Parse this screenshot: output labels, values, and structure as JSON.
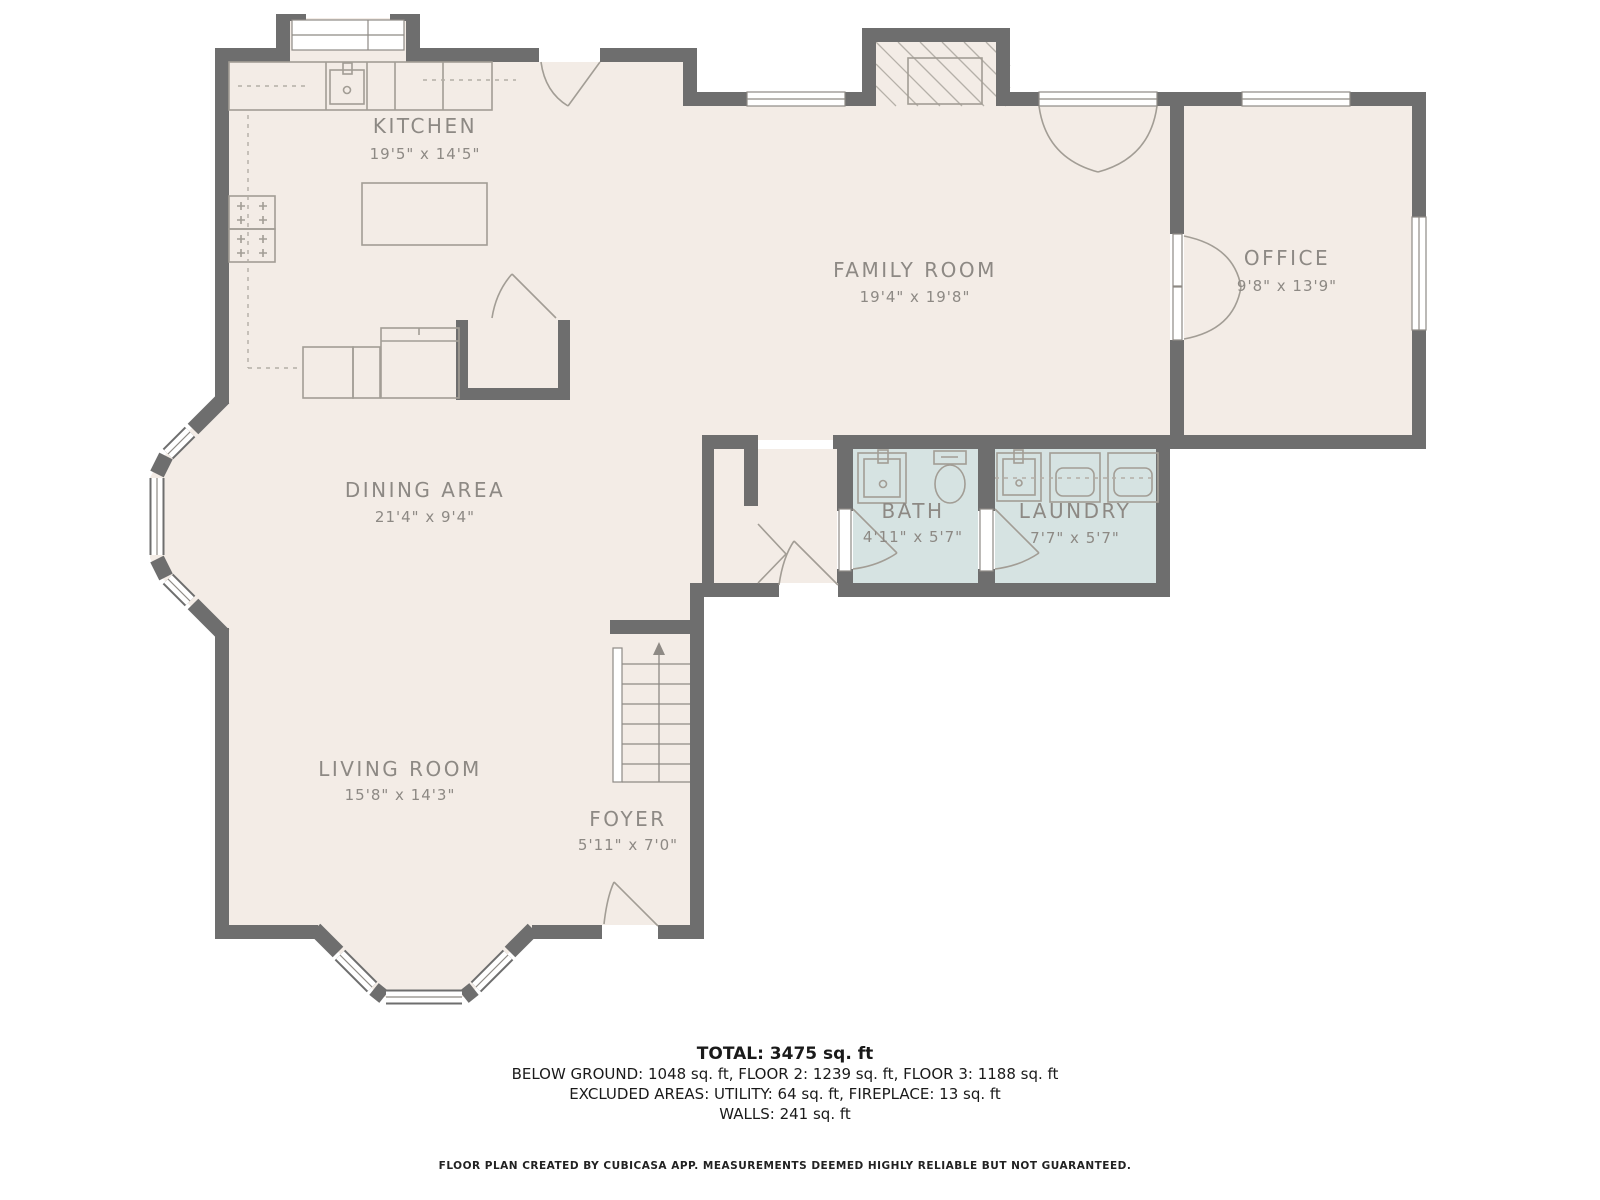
{
  "rooms": {
    "kitchen": {
      "name": "KITCHEN",
      "dims": "19'5\" x 14'5\""
    },
    "family_room": {
      "name": "FAMILY ROOM",
      "dims": "19'4\" x 19'8\""
    },
    "office": {
      "name": "OFFICE",
      "dims": "9'8\" x 13'9\""
    },
    "dining_area": {
      "name": "DINING AREA",
      "dims": "21'4\" x 9'4\""
    },
    "bath": {
      "name": "BATH",
      "dims": "4'11\" x 5'7\""
    },
    "laundry": {
      "name": "LAUNDRY",
      "dims": "7'7\" x 5'7\""
    },
    "living_room": {
      "name": "LIVING ROOM",
      "dims": "15'8\" x 14'3\""
    },
    "foyer": {
      "name": "FOYER",
      "dims": "5'11\" x 7'0\""
    }
  },
  "summary": {
    "total": "TOTAL: 3475 sq. ft",
    "floors": "BELOW GROUND: 1048 sq. ft, FLOOR 2: 1239 sq. ft, FLOOR 3: 1188 sq. ft",
    "excluded_areas": "EXCLUDED AREAS: UTILITY: 64 sq. ft, FIREPLACE: 13 sq. ft",
    "walls": "WALLS: 241 sq. ft"
  },
  "footer": {
    "credit": "FLOOR PLAN CREATED BY CUBICASA APP. MEASUREMENTS DEEMED HIGHLY RELIABLE BUT NOT GUARANTEED."
  },
  "colors": {
    "floor": "#f3ece6",
    "wall": "#6e6e6e",
    "wet_room_floor": "#d6e3e2",
    "room_label": "#8d8984",
    "summary_text": "#1a1a1a"
  }
}
